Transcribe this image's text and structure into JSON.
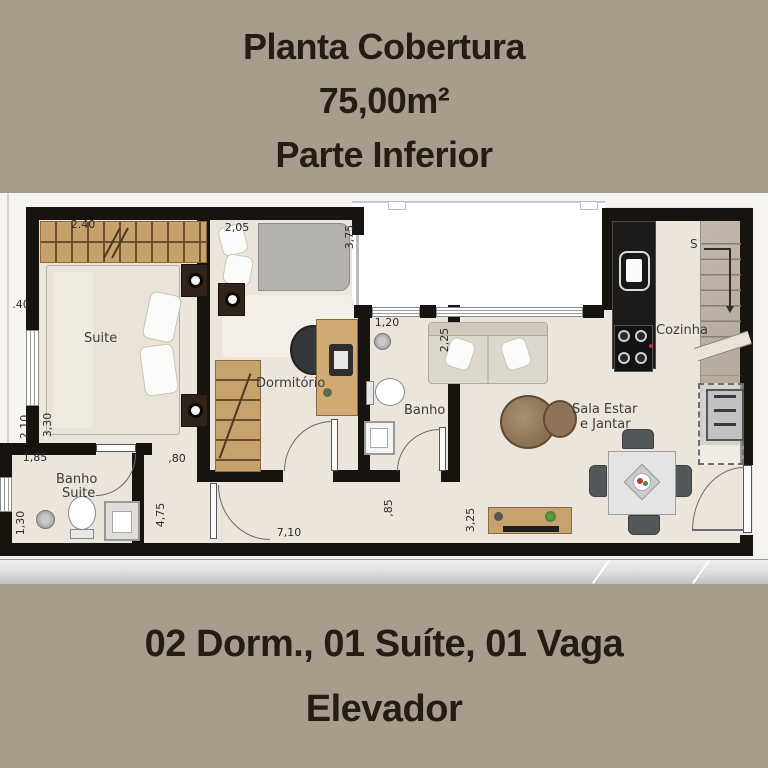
{
  "header": {
    "title": "Planta Cobertura",
    "area": "75,00m²",
    "subtitle": "Parte Inferior"
  },
  "footer": {
    "line1": "02 Dorm., 01 Suíte, 01 Vaga",
    "line2": "Elevador"
  },
  "plan": {
    "rooms": {
      "suite": "Suite",
      "dormitorio": "Dormitório",
      "banho": "Banho",
      "banho_suite_line1": "Banho",
      "banho_suite_line2": "Suite",
      "cozinha": "Cozinha",
      "sala_line1": "Sala Estar",
      "sala_line2": "e Jantar",
      "stairs_marker": "S"
    },
    "dims": {
      "suite_wardrobe_width": "2.40",
      "dorm_width": "2,05",
      "dorm_depth": "3,75",
      "left_setback": ".40",
      "suite_depth_a": "2,10",
      "suite_depth_b": "3,30",
      "banho_suite_width": "1,85",
      "banho_suite_depth": "1,30",
      "hall_width": ",80",
      "hall_depth": "4,75",
      "living_width": "7,10",
      "banho_width": "1,20",
      "banho_depth": "2,25",
      "tv_wall": "3,25",
      "wall_segment": ",85"
    },
    "colors": {
      "background": "#a89c8c",
      "text": "#241d13",
      "wall": "#17130e",
      "floor": "#ebe5dc",
      "wood": "#c8a26c"
    }
  }
}
